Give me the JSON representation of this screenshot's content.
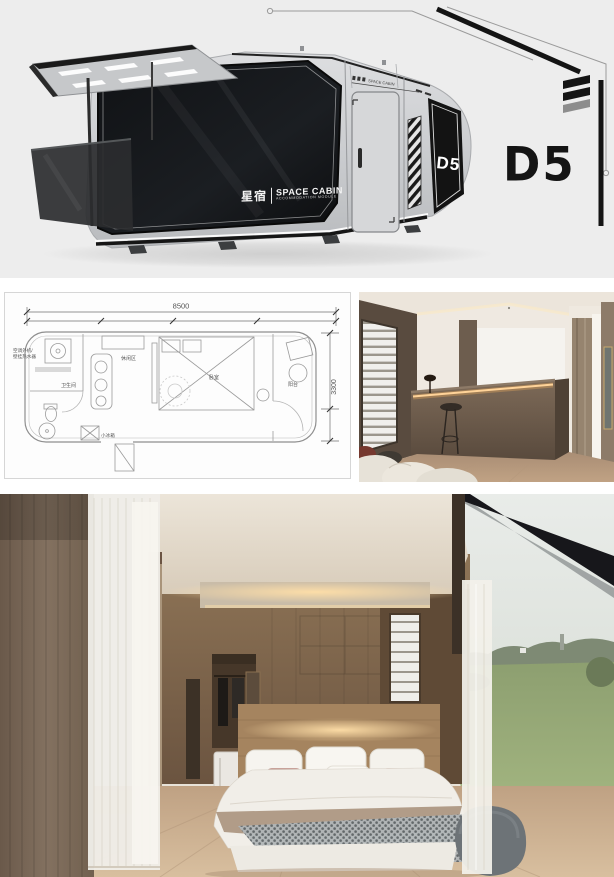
{
  "hero": {
    "brand_cn": "星宿",
    "brand_en": "SPACE CABIN",
    "brand_sub": "ACCOMMODATION MODULE",
    "side_badge": "D5",
    "logo": "D5",
    "roof_label": "SPACE CABIN"
  },
  "floorplan": {
    "width_label": "8500",
    "depth_label": "3300",
    "labels": {
      "ac1": "空调外机/",
      "ac2": "壁挂热水器",
      "bathroom": "卫生间",
      "lounge": "休闲区",
      "bedroom": "卧室",
      "balcony": "阳台",
      "fridge": "小冰箱"
    }
  },
  "colors": {
    "hero_bg": "#ededed",
    "accent_black": "#141414",
    "cabin_gray": "#d2d4d6",
    "glass_black": "#15171a",
    "led_warm": "#f6c583",
    "wood_wall": "#85684c",
    "floor_wood": "#c7ab8b",
    "curtain_brown": "#7b6a59",
    "sheer_white": "#efede8",
    "grass_green": "#95a677",
    "sky_gray": "#e4e8e5"
  }
}
